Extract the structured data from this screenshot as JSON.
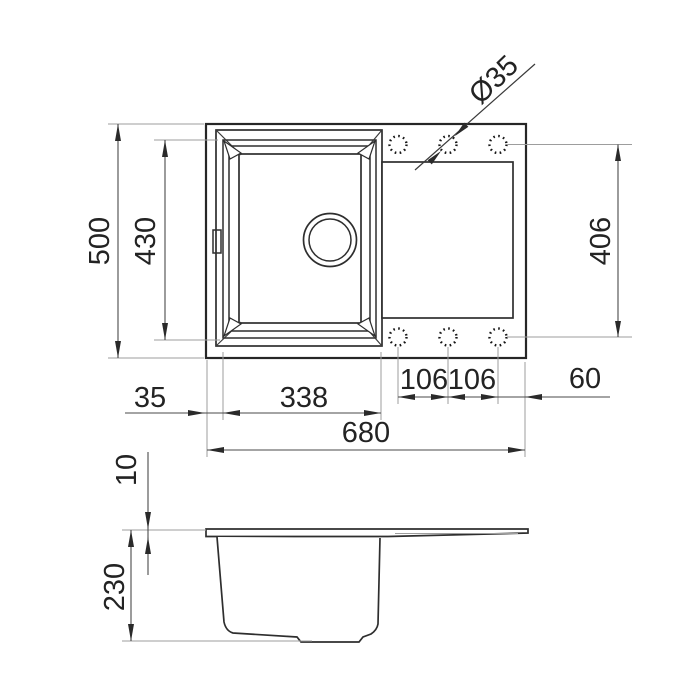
{
  "drawing": {
    "type": "technical-drawing",
    "subject": "kitchen sink with drainboard - dimensioned top view and side section",
    "colors": {
      "background": "#ffffff",
      "outline": "#2e2e2e",
      "dimension_line": "#4a4a4a",
      "extension_line": "#9d9d9d",
      "text": "#232323"
    },
    "dimensions": {
      "overall_depth": "500",
      "bowl_depth": "430",
      "hole_diameter": "Ø35",
      "hole_span": "406",
      "left_offset": "35",
      "bowl_width": "338",
      "hole_spacing_left": "106",
      "hole_spacing_right": "106",
      "right_offset": "60",
      "overall_width": "680",
      "top_thickness": "10",
      "bowl_height": "230"
    }
  }
}
